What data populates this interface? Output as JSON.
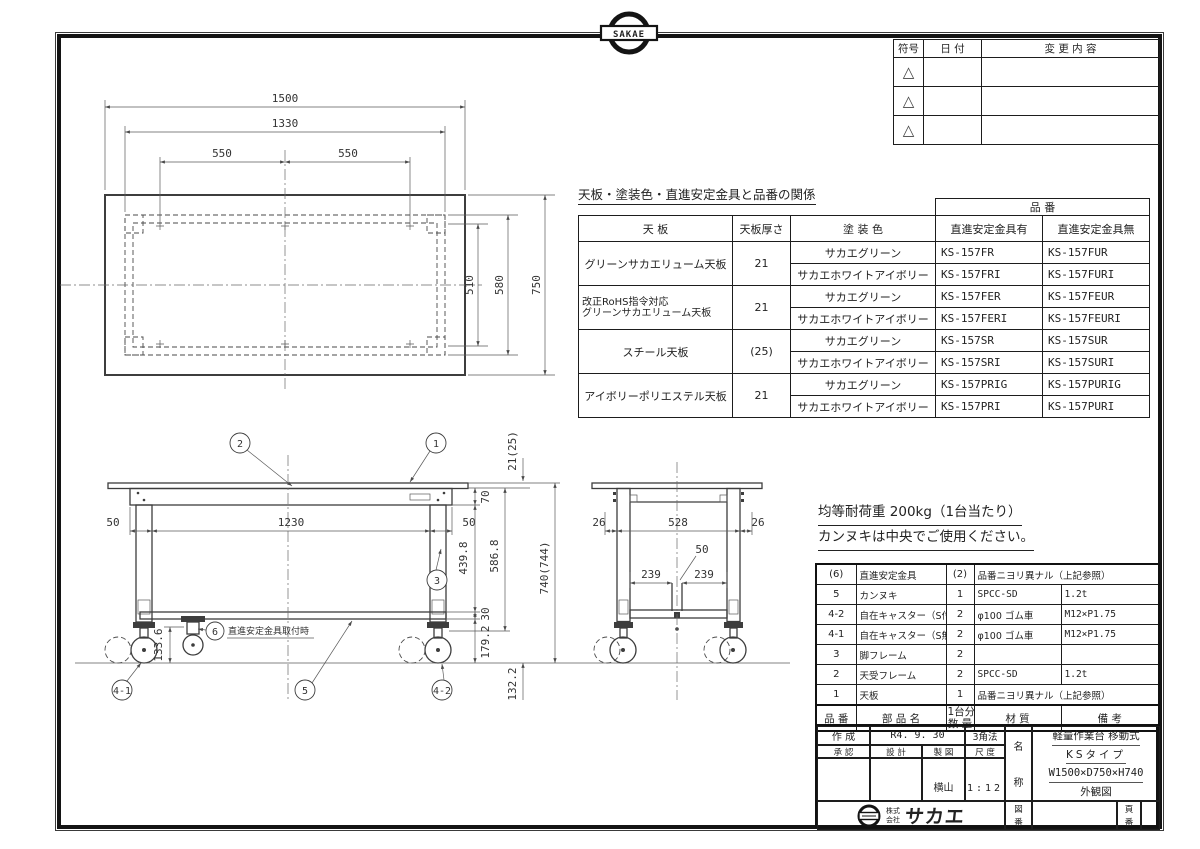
{
  "sheet": {
    "logo_text": "SAKAE",
    "company_prefix1": "株式",
    "company_prefix2": "会社",
    "company_name": "サカエ"
  },
  "revision_table": {
    "col_symbol": "符号",
    "col_date": "日 付",
    "col_change": "変 更 内 容",
    "marker": "△"
  },
  "product_table": {
    "title": "天板・塗装色・直進安定金具と品番の関係",
    "h_tenban": "天 板",
    "h_thickness": "天板厚さ",
    "h_color": "塗 装 色",
    "h_hinban": "品 番",
    "h_with": "直進安定金具有",
    "h_without": "直進安定金具無",
    "groups": [
      {
        "name1": "グリーンサカエリューム天板",
        "name2": "",
        "thickness": "21",
        "colors": [
          "サカエグリーン",
          "サカエホワイトアイボリー"
        ],
        "with": [
          "KS-157FR",
          "KS-157FRI"
        ],
        "without": [
          "KS-157FUR",
          "KS-157FURI"
        ]
      },
      {
        "name1": "改正RoHS指令対応",
        "name2": "グリーンサカエリューム天板",
        "thickness": "21",
        "colors": [
          "サカエグリーン",
          "サカエホワイトアイボリー"
        ],
        "with": [
          "KS-157FER",
          "KS-157FERI"
        ],
        "without": [
          "KS-157FEUR",
          "KS-157FEURI"
        ]
      },
      {
        "name1": "スチール天板",
        "name2": "",
        "thickness": "(25)",
        "colors": [
          "サカエグリーン",
          "サカエホワイトアイボリー"
        ],
        "with": [
          "KS-157SR",
          "KS-157SRI"
        ],
        "without": [
          "KS-157SUR",
          "KS-157SURI"
        ]
      },
      {
        "name1": "アイボリーポリエステル天板",
        "name2": "",
        "thickness": "21",
        "colors": [
          "サカエグリーン",
          "サカエホワイトアイボリー"
        ],
        "with": [
          "KS-157PRIG",
          "KS-157PRI"
        ],
        "without": [
          "KS-157PURIG",
          "KS-157PURI"
        ]
      }
    ]
  },
  "notes": {
    "line1": "均等耐荷重 200kg（1台当たり）",
    "line2": "カンヌキは中央でご使用ください。"
  },
  "parts_table": {
    "h_no": "品 番",
    "h_name": "部 品 名",
    "h_qty1": "1台分",
    "h_qty2": "数 量",
    "h_material": "材 質",
    "h_remarks": "備 考",
    "rows": [
      {
        "no": "(6)",
        "name": "直進安定金具",
        "qty": "(2)",
        "material": "品番ニヨリ異ナル（上記参照）",
        "remarks": ""
      },
      {
        "no": "5",
        "name": "カンヌキ",
        "qty": "1",
        "material": "SPCC-SD",
        "remarks": "1.2t"
      },
      {
        "no": "4-2",
        "name": "自在キャスター（S付）",
        "qty": "2",
        "material": "φ100 ゴム車",
        "remarks": "M12×P1.75"
      },
      {
        "no": "4-1",
        "name": "自在キャスター（S無）",
        "qty": "2",
        "material": "φ100 ゴム車",
        "remarks": "M12×P1.75"
      },
      {
        "no": "3",
        "name": "脚フレーム",
        "qty": "2",
        "material": "",
        "remarks": ""
      },
      {
        "no": "2",
        "name": "天受フレーム",
        "qty": "2",
        "material": "SPCC-SD",
        "remarks": "1.2t"
      },
      {
        "no": "1",
        "name": "天板",
        "qty": "1",
        "material": "品番ニヨリ異ナル（上記参照）",
        "remarks": ""
      }
    ]
  },
  "title_block": {
    "created_label": "作 成",
    "created_date": "R4. 9. 30",
    "projection": "3角法",
    "approve_label": "承 認",
    "design_label": "設 計",
    "draft_label": "製 図",
    "scale_label": "尺 度",
    "drafter": "横山",
    "scale": "1:12",
    "name_label_1": "名",
    "name_label_2": "称",
    "product_line1": "軽量作業台 移動式",
    "product_line2": "KSタイプ",
    "product_line3": "W1500×D750×H740",
    "product_line4": "外観図",
    "drawing_no_label_1": "図",
    "drawing_no_label_2": "番",
    "page_no_label_1": "頁",
    "page_no_label_2": "番"
  },
  "drawing": {
    "plan": {
      "w_total": "1500",
      "w_frame": "1330",
      "w_pitch_l": "550",
      "w_pitch_r": "550",
      "d_inner": "510",
      "d_frame": "580",
      "d_total": "750"
    },
    "front": {
      "side_l": "50",
      "span": "1230",
      "side_r": "50",
      "apron_h": "70",
      "leg_h": "439.8",
      "bar_h": "30",
      "lower_h": "179.2",
      "frame_h": "586.8",
      "top_t": "21(25)",
      "total_h": "740(744)",
      "stab_h": "133.6",
      "ground_h": "132.2"
    },
    "side": {
      "side_l": "26",
      "span": "528",
      "side_r": "26",
      "half_l": "239",
      "half_r": "239",
      "gap": "50"
    },
    "balloons": {
      "b1": "1",
      "b2": "2",
      "b3": "3",
      "b41": "4-1",
      "b42": "4-2",
      "b5": "5",
      "b6": "6"
    },
    "b6_note": "直進安定金具取付時"
  }
}
